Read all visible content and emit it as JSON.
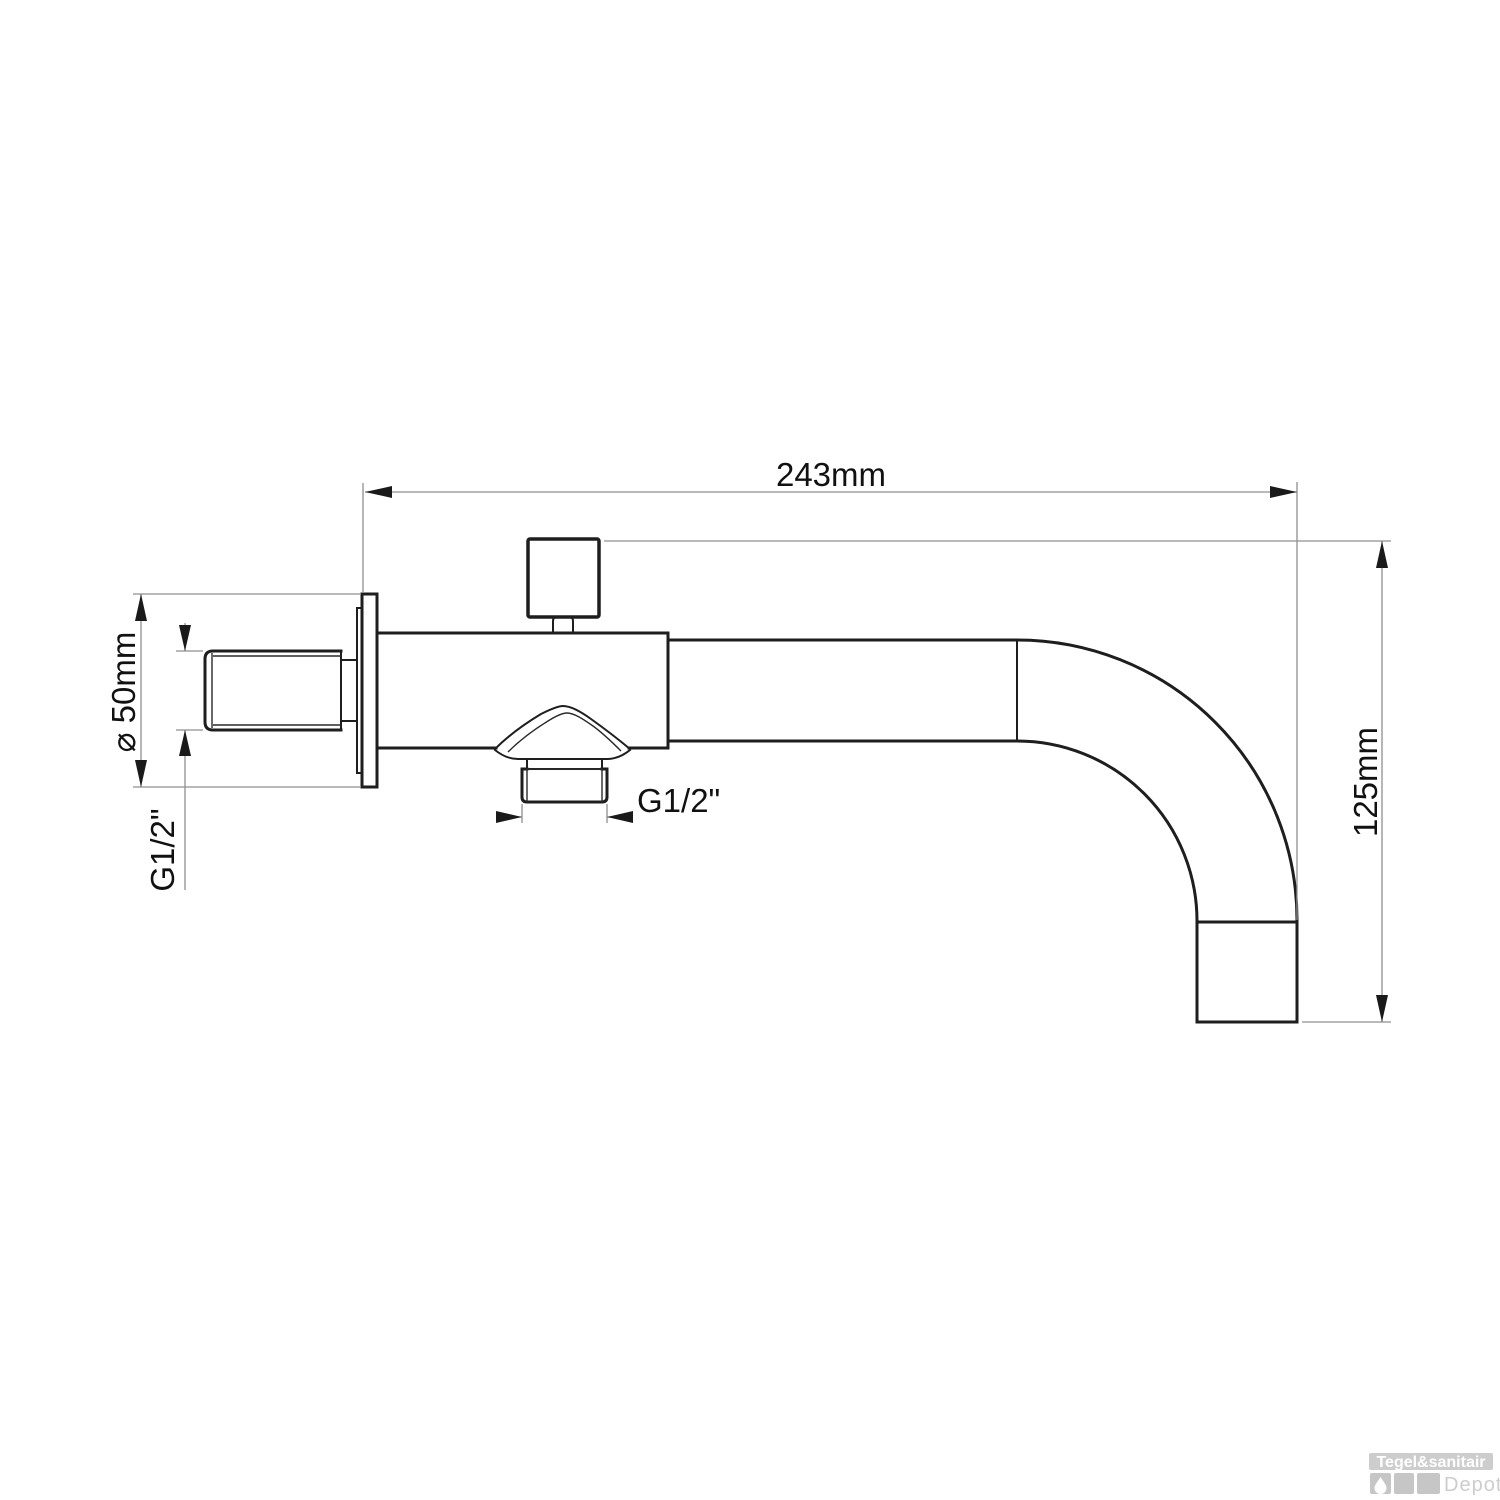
{
  "drawing": {
    "type": "technical-drawing",
    "subject": "wall-mounted bath spout with diverter, side view",
    "labels": {
      "width": "243mm",
      "height": "125mm",
      "flange_diameter": "⌀ 50mm",
      "wall_thread": "G1/2\"",
      "outlet_thread": "G1/2\""
    },
    "colors": {
      "outline": "#1e1e1e",
      "dimension_line": "#8f8f8f",
      "text": "#111111"
    }
  },
  "watermark": {
    "brand": "Tegel&sanitair",
    "suffix": "Depot",
    "colors": {
      "badge_bg": "#cdcdcd",
      "badge_text": "#ffffff",
      "square": "#c6c6c6",
      "suffix_text": "#cdcdcd"
    }
  }
}
